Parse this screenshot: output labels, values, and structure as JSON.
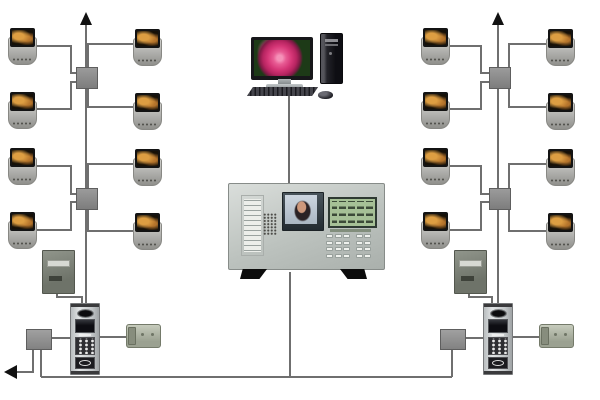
{
  "diagram": {
    "title": "video-intercom-building-riser-diagram",
    "description_semantics": "Two riser trunks of indoor monitors with splitters feed from door stations; central management console linked to PC workstation; bottom bus joins door-station junction boxes, power supplies and electric locks."
  },
  "colors": {
    "background": "#ffffff",
    "wire": "#6f6f6f",
    "arrow": "#111111",
    "monitor_screen_bg": "#161007",
    "monitor_screen_glow": "#dd9e42",
    "lcd": "#a6c096",
    "lcd_dark": "#3c4a38",
    "photo_skin": "#cd987c",
    "photo_hair": "#2b2225",
    "rose_bg": "#1d3a17",
    "station_dark": "#2e2e32"
  },
  "nodes": {
    "monitors": [
      {
        "x": 8,
        "y": 28
      },
      {
        "x": 8,
        "y": 92
      },
      {
        "x": 8,
        "y": 148
      },
      {
        "x": 8,
        "y": 212
      },
      {
        "x": 133,
        "y": 29
      },
      {
        "x": 133,
        "y": 93
      },
      {
        "x": 133,
        "y": 149
      },
      {
        "x": 133,
        "y": 213
      },
      {
        "x": 421,
        "y": 28
      },
      {
        "x": 421,
        "y": 92
      },
      {
        "x": 421,
        "y": 148
      },
      {
        "x": 421,
        "y": 212
      },
      {
        "x": 546,
        "y": 29
      },
      {
        "x": 546,
        "y": 93
      },
      {
        "x": 546,
        "y": 149
      },
      {
        "x": 546,
        "y": 213
      }
    ],
    "splitters": [
      {
        "x": 76,
        "y": 67
      },
      {
        "x": 76,
        "y": 188
      },
      {
        "x": 489,
        "y": 67
      },
      {
        "x": 489,
        "y": 188
      }
    ],
    "junction_boxes": [
      {
        "x": 26,
        "y": 329
      },
      {
        "x": 440,
        "y": 329
      }
    ],
    "power_supplies": [
      {
        "x": 42,
        "y": 250
      },
      {
        "x": 454,
        "y": 250
      }
    ],
    "door_stations": [
      {
        "x": 70,
        "y": 303
      },
      {
        "x": 483,
        "y": 303
      }
    ],
    "locks": [
      {
        "x": 126,
        "y": 324
      },
      {
        "x": 539,
        "y": 324
      }
    ]
  },
  "wires": [
    {
      "name": "left-riser-trunk",
      "points": [
        [
          86,
          20
        ],
        [
          86,
          304
        ]
      ]
    },
    {
      "name": "right-riser-trunk",
      "points": [
        [
          498,
          20
        ],
        [
          498,
          304
        ]
      ]
    },
    {
      "name": "monitor-link-l1-outer",
      "points": [
        [
          37,
          46
        ],
        [
          71,
          46
        ],
        [
          71,
          73
        ],
        [
          77,
          73
        ]
      ]
    },
    {
      "name": "monitor-link-l1-inner",
      "points": [
        [
          133,
          44
        ],
        [
          88,
          44
        ],
        [
          88,
          68
        ]
      ]
    },
    {
      "name": "monitor-link-l2-outer",
      "points": [
        [
          37,
          109
        ],
        [
          71,
          109
        ],
        [
          71,
          82
        ],
        [
          77,
          82
        ]
      ]
    },
    {
      "name": "monitor-link-l2-inner",
      "points": [
        [
          133,
          107
        ],
        [
          88,
          107
        ],
        [
          88,
          86
        ]
      ]
    },
    {
      "name": "monitor-link-l3-outer",
      "points": [
        [
          37,
          166
        ],
        [
          71,
          166
        ],
        [
          71,
          194
        ],
        [
          77,
          194
        ]
      ]
    },
    {
      "name": "monitor-link-l3-inner",
      "points": [
        [
          133,
          164
        ],
        [
          88,
          164
        ],
        [
          88,
          189
        ]
      ]
    },
    {
      "name": "monitor-link-l4-outer",
      "points": [
        [
          37,
          230
        ],
        [
          71,
          230
        ],
        [
          71,
          202
        ],
        [
          77,
          202
        ]
      ]
    },
    {
      "name": "monitor-link-l4-inner",
      "points": [
        [
          133,
          231
        ],
        [
          88,
          231
        ],
        [
          88,
          206
        ]
      ]
    },
    {
      "name": "monitor-link-r1-inner",
      "points": [
        [
          450,
          46
        ],
        [
          481,
          46
        ],
        [
          481,
          73
        ],
        [
          490,
          73
        ]
      ]
    },
    {
      "name": "monitor-link-r1-outer",
      "points": [
        [
          546,
          44
        ],
        [
          509,
          44
        ],
        [
          509,
          68
        ]
      ]
    },
    {
      "name": "monitor-link-r2-inner",
      "points": [
        [
          450,
          109
        ],
        [
          481,
          109
        ],
        [
          481,
          82
        ],
        [
          490,
          82
        ]
      ]
    },
    {
      "name": "monitor-link-r2-outer",
      "points": [
        [
          546,
          107
        ],
        [
          509,
          107
        ],
        [
          509,
          86
        ]
      ]
    },
    {
      "name": "monitor-link-r3-inner",
      "points": [
        [
          450,
          166
        ],
        [
          481,
          166
        ],
        [
          481,
          194
        ],
        [
          490,
          194
        ]
      ]
    },
    {
      "name": "monitor-link-r3-outer",
      "points": [
        [
          546,
          164
        ],
        [
          509,
          164
        ],
        [
          509,
          189
        ]
      ]
    },
    {
      "name": "monitor-link-r4-inner",
      "points": [
        [
          450,
          230
        ],
        [
          481,
          230
        ],
        [
          481,
          202
        ],
        [
          490,
          202
        ]
      ]
    },
    {
      "name": "monitor-link-r4-outer",
      "points": [
        [
          546,
          231
        ],
        [
          509,
          231
        ],
        [
          509,
          206
        ]
      ]
    },
    {
      "name": "pc-to-console-link",
      "points": [
        [
          289,
          96
        ],
        [
          289,
          184
        ]
      ]
    },
    {
      "name": "console-to-bus-link",
      "points": [
        [
          290,
          272
        ],
        [
          290,
          377
        ]
      ]
    },
    {
      "name": "bottom-bus",
      "points": [
        [
          41,
          377
        ],
        [
          452,
          377
        ]
      ]
    },
    {
      "name": "left-junction-branch-out",
      "points": [
        [
          33,
          348
        ],
        [
          33,
          372
        ],
        [
          16,
          372
        ]
      ]
    },
    {
      "name": "left-junction-to-bus",
      "points": [
        [
          41,
          348
        ],
        [
          41,
          377
        ]
      ]
    },
    {
      "name": "left-junction-to-station",
      "points": [
        [
          50,
          338
        ],
        [
          71,
          338
        ]
      ]
    },
    {
      "name": "left-power-feed",
      "points": [
        [
          57,
          291
        ],
        [
          57,
          297
        ],
        [
          82,
          297
        ],
        [
          82,
          304
        ]
      ]
    },
    {
      "name": "left-station-to-lock",
      "points": [
        [
          97,
          337
        ],
        [
          127,
          337
        ]
      ]
    },
    {
      "name": "right-junction-to-bus",
      "points": [
        [
          452,
          348
        ],
        [
          452,
          377
        ]
      ]
    },
    {
      "name": "right-junction-to-station",
      "points": [
        [
          464,
          338
        ],
        [
          484,
          338
        ]
      ]
    },
    {
      "name": "right-power-feed",
      "points": [
        [
          469,
          291
        ],
        [
          469,
          297
        ],
        [
          492,
          297
        ],
        [
          492,
          304
        ]
      ]
    },
    {
      "name": "right-station-to-lock",
      "points": [
        [
          511,
          337
        ],
        [
          540,
          337
        ]
      ]
    }
  ],
  "arrows": [
    {
      "name": "riser-continuation-arrow-left",
      "points": "86,12 80,25 92,25"
    },
    {
      "name": "riser-continuation-arrow-right",
      "points": "498,12 492,25 504,25"
    },
    {
      "name": "bus-continuation-arrow",
      "points": "4,372 17,365 17,379"
    }
  ]
}
